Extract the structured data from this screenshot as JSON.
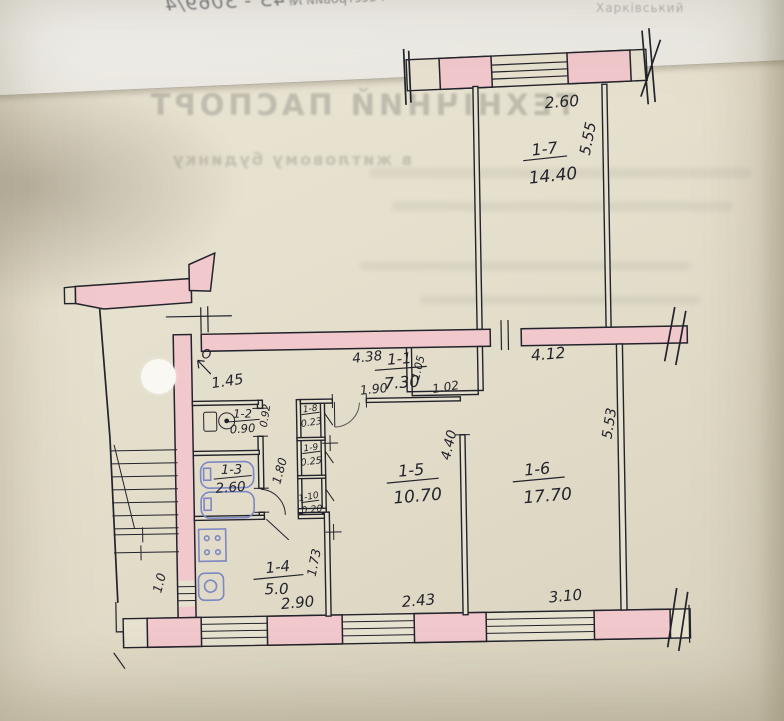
{
  "document": {
    "registry_label": "Реєстровий №",
    "registry_number": "43 - 3069/4",
    "corner_text": "Харківський",
    "bleed_title": "ТЕХНІЧНИЙ ПАСПОРТ",
    "bleed_subtitle": "в житловому будинку"
  },
  "plan": {
    "rooms": {
      "r11": {
        "id": "1-1",
        "area": "7.30"
      },
      "r12": {
        "id": "1-2",
        "area": "0.90"
      },
      "r13": {
        "id": "1-3",
        "area": "2.60"
      },
      "r14": {
        "id": "1-4",
        "area": "5.0"
      },
      "r15": {
        "id": "1-5",
        "area": "10.70"
      },
      "r16": {
        "id": "1-6",
        "area": "17.70"
      },
      "r17": {
        "id": "1-7",
        "area": "14.40"
      },
      "r18": {
        "id": "1-8",
        "area": "0.23"
      },
      "r19": {
        "id": "1-9",
        "area": "0.25"
      },
      "r110": {
        "id": "1-10",
        "area": "0.20"
      }
    },
    "dims": {
      "balcony_width": "2.60",
      "balcony_right": "5.55",
      "top_wall_right": "4.12",
      "room6_right": "5.53",
      "hall_top": "4.38",
      "niche_depth": "1.05",
      "niche_width": "1.02",
      "room5_entry": "1.90",
      "entrance_mark": "O",
      "entrance_width": "1.45",
      "wc_side": "0.92",
      "bath_side": "1.80",
      "room5_side": "4.40",
      "kitchen_side": "1.73",
      "stairs_bottom": "1.0",
      "kitchen_bottom": "2.90",
      "room5_bottom": "2.43",
      "room6_bottom": "3.10"
    }
  },
  "colors": {
    "paper": "#e4decc",
    "wall_pink": "#f1c8cc",
    "ink": "#23232b",
    "fixture_blue": "#7d88c4"
  }
}
